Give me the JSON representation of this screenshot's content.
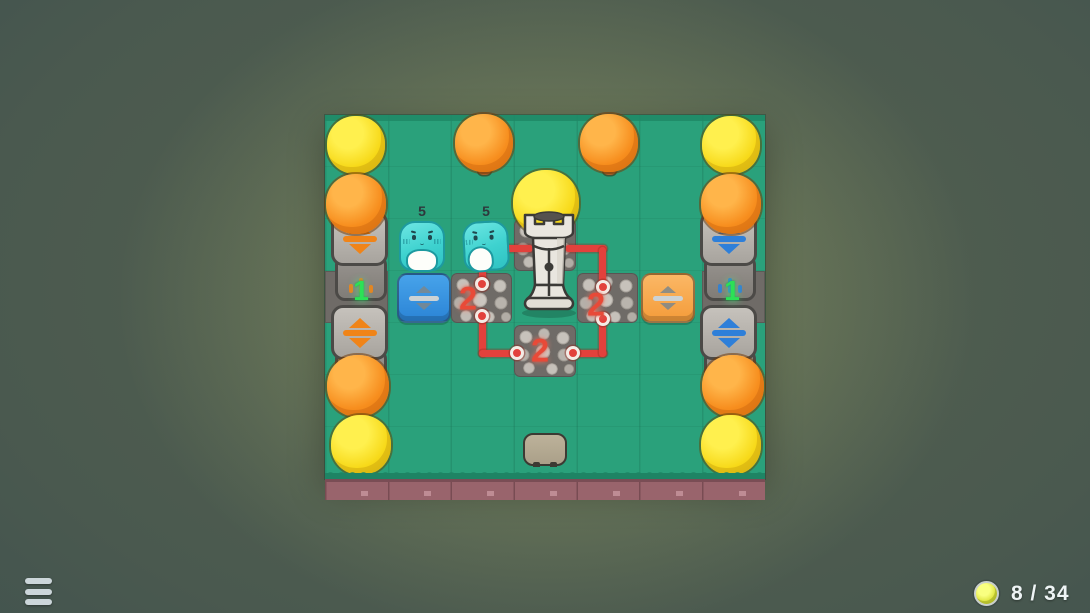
{
  "hud": {
    "menu": {
      "icon": "hamburger-menu-icon"
    },
    "score": {
      "icon": "coin-icon",
      "value": "8 / 34"
    }
  },
  "board": {
    "creatures": [
      {
        "id": "slime-left",
        "count": "5",
        "color": "#3ed2cf"
      },
      {
        "id": "slime-right",
        "count": "5",
        "color": "#3ed2cf"
      }
    ],
    "rock_piles": [
      {
        "position": "left",
        "count": "2"
      },
      {
        "position": "right",
        "count": "2"
      },
      {
        "position": "bottom",
        "count": "2"
      }
    ],
    "lane_counters": [
      {
        "side": "left",
        "value": "1",
        "color": "#2ce156"
      },
      {
        "side": "right",
        "value": "1",
        "color": "#2ce156"
      }
    ],
    "tiles": {
      "flat_arrow_left": {
        "color": "#2f8fe0",
        "glyph": "up-down-arrows"
      },
      "flat_arrow_right": {
        "color": "#f9a94d",
        "glyph": "up-down-arrows"
      },
      "devices": [
        {
          "pos": "left-top",
          "accent": "#f08418",
          "glyph": "up-down-arrows"
        },
        {
          "pos": "left-bottom",
          "accent": "#f08418",
          "glyph": "up-down-arrows"
        },
        {
          "pos": "right-top",
          "accent": "#2e7fd9",
          "glyph": "up-down-arrows"
        },
        {
          "pos": "right-bottom",
          "accent": "#2e7fd9",
          "glyph": "up-down-arrows"
        }
      ]
    },
    "structures": [
      {
        "id": "tower",
        "type": "rook-tower"
      },
      {
        "id": "stone-slab",
        "type": "rock"
      }
    ],
    "trees": {
      "yellow": 4,
      "orange": 6,
      "big_yellow_center": 1
    },
    "connections": "red wires link slime-right, tower and the three rock piles"
  }
}
